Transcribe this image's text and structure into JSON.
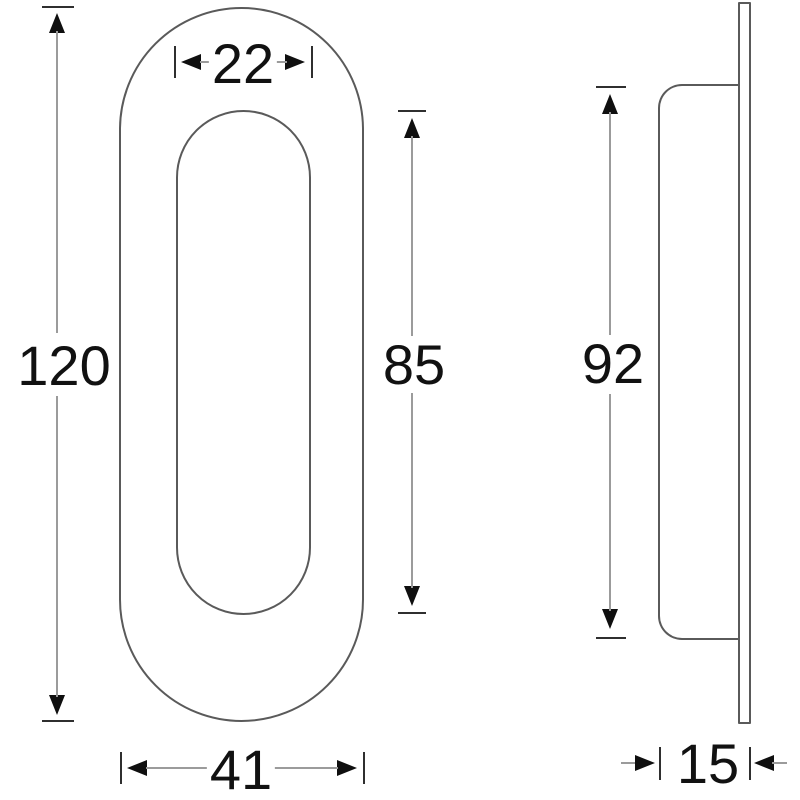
{
  "front_view": {
    "overall_height_label": "120",
    "recess_width_label": "22",
    "recess_height_label": "85",
    "overall_width_label": "41"
  },
  "side_view": {
    "height_label": "92",
    "depth_label": "15"
  },
  "colors": {
    "background": "#ffffff",
    "outline": "#5a5a5a",
    "dimension_line": "#9b9b9b",
    "tick": "#2f2f2f",
    "arrow": "#0f0f0f",
    "text": "#111111"
  }
}
